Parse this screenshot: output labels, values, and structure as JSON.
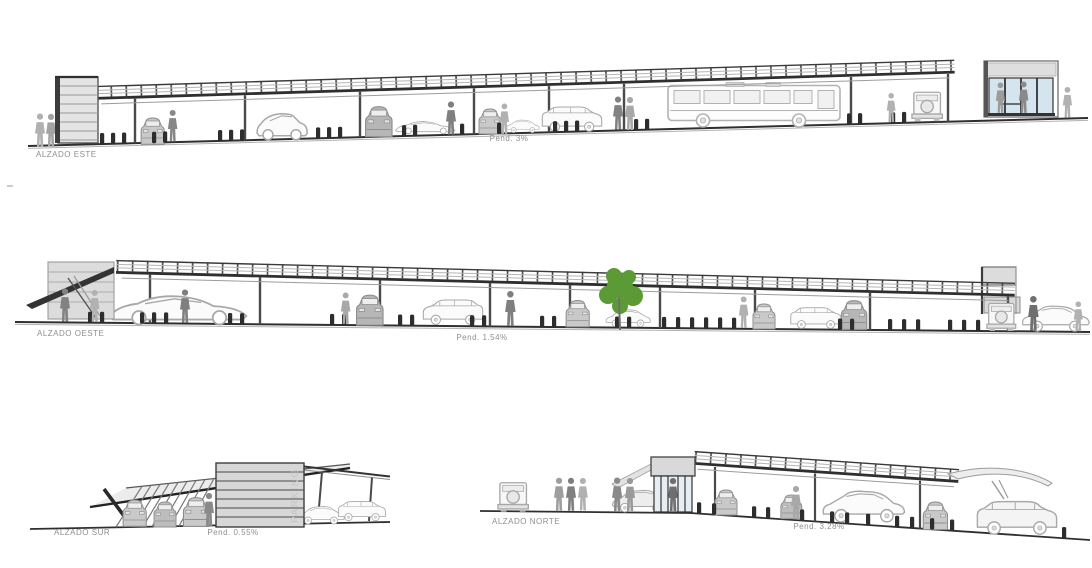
{
  "drawing": {
    "elevations": [
      {
        "id": "este",
        "label": "ALZADO ESTE",
        "slope": "Pend. 3%"
      },
      {
        "id": "oeste",
        "label": "ALZADO OESTE",
        "slope": "Pend. 1.54%"
      },
      {
        "id": "sur",
        "label": "ALZADO SUR",
        "slope": "Pend. 0.55%"
      },
      {
        "id": "norte",
        "label": "ALZADO NORTE",
        "slope": "Pend. 3.28%"
      }
    ],
    "tower_sign": "PARKING",
    "colors": {
      "background": "#ffffff",
      "line_dark": "#2f2f2f",
      "structure_gray": "#dcdcdc",
      "detail_gray": "#9a9a9a",
      "car_line": "#a8a8a8",
      "people_dark": "#878787",
      "people_light": "#b1b1b1",
      "glass_blue": "#d5e5ef",
      "tree_green": "#5b9a35",
      "label_gray": "#8f8f8f"
    }
  }
}
